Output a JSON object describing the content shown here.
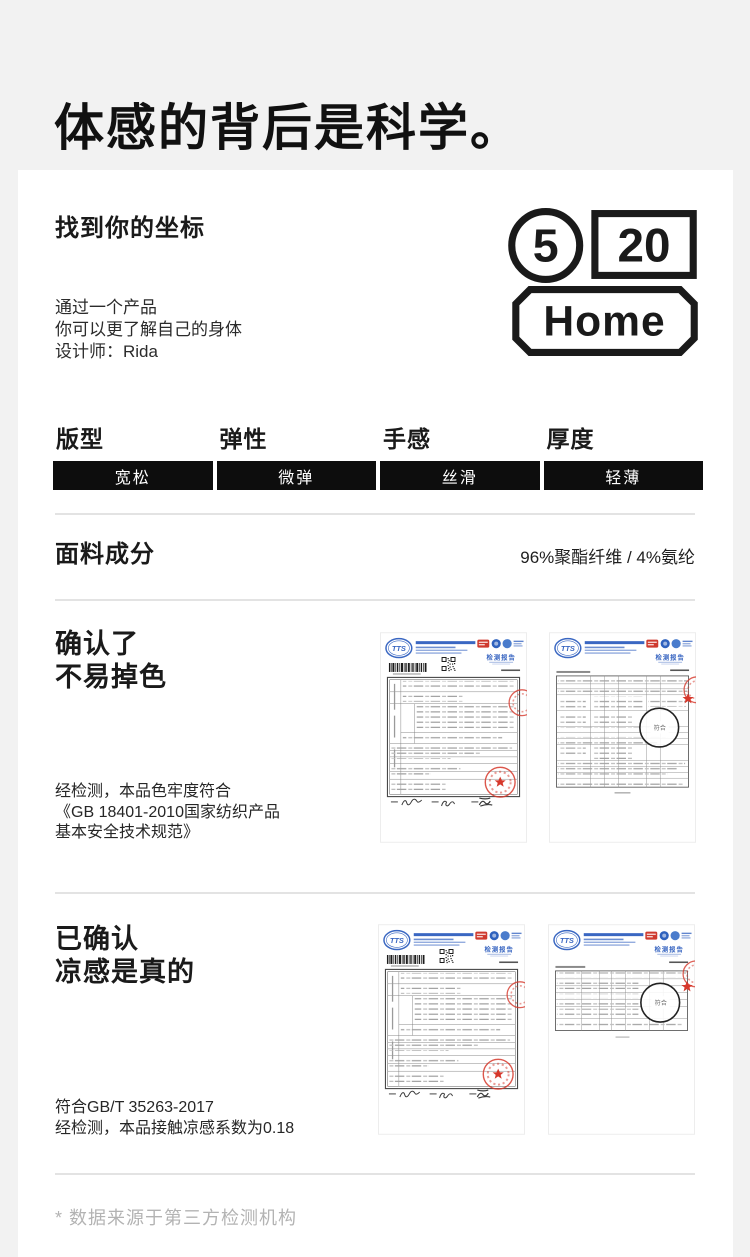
{
  "hero": {
    "title": "体感的背后是科学。"
  },
  "intro": {
    "heading": "找到你的坐标",
    "lines": [
      "通过一个产品",
      "你可以更了解自己的身体",
      "设计师：Rida"
    ],
    "logo": {
      "circle": "5",
      "box": "20",
      "plate": "Home"
    }
  },
  "attributes": [
    {
      "label": "版型",
      "value": "宽松"
    },
    {
      "label": "弹性",
      "value": "微弹"
    },
    {
      "label": "手感",
      "value": "丝滑"
    },
    {
      "label": "厚度",
      "value": "轻薄"
    }
  ],
  "fabric": {
    "label": "面料成分",
    "value": "96%聚酯纤维 / 4%氨纶"
  },
  "sections": {
    "colorfast": {
      "heading_lines": [
        "确认了",
        "不易掉色"
      ],
      "body_lines": [
        "经检测，本品色牢度符合",
        "《GB 18401-2010国家纺织产品",
        "基本安全技术规范》"
      ]
    },
    "cooling": {
      "heading_lines": [
        "已确认",
        "凉感是真的"
      ],
      "body_lines": [
        "符合GB/T 35263-2017",
        "经检测，本品接触凉感系数为0.18"
      ]
    }
  },
  "report": {
    "lab_logo": "TTS",
    "title": "检测报告",
    "pass_label": "符合"
  },
  "footnote": "* 数据来源于第三方检测机构",
  "colors": {
    "page_bg": "#f2f2f2",
    "card_bg": "#ffffff",
    "bar_black": "#0d0d0d",
    "report_blue": "#3a67c2",
    "stamp_red": "#d6382c",
    "footnote_gray": "#b3b3b3"
  }
}
